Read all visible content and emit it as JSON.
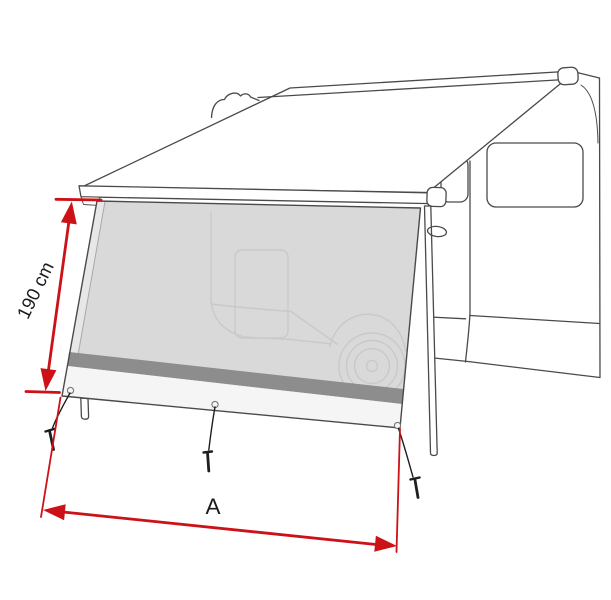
{
  "diagram": {
    "name": "awning-front-panel-dimension-drawing",
    "labels": {
      "height": "190 cm",
      "width": "A"
    },
    "colors": {
      "background": "#ffffff",
      "line_art": "#4a4a4a",
      "ghost_line": "#c9c9c9",
      "panel_fill": "#d9d9d9",
      "panel_fold_fill": "#e7e7e7",
      "stripe_fill": "#8d8d8d",
      "panel_lower_fill": "#f5f5f5",
      "hardware_black": "#1f1f1f",
      "dimension_red": "#cc1117",
      "text": "#1b1b1b"
    }
  }
}
